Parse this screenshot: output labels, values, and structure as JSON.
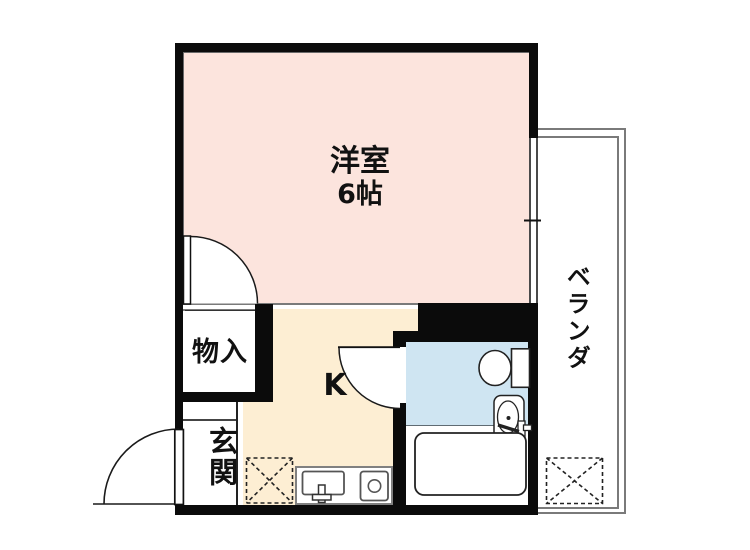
{
  "title": "1K apartment floor plan",
  "rooms": {
    "western": {
      "label": "洋室",
      "size": "6帖"
    },
    "kitchen": {
      "label": "K"
    },
    "storage": {
      "label": "物入"
    },
    "entrance": {
      "label": "玄関"
    },
    "veranda": {
      "label": "ベランダ"
    }
  },
  "fixtures": [
    "toilet",
    "washbasin",
    "bathtub",
    "kitchen-sink",
    "stove",
    "refrigerator-space",
    "washing-machine-space",
    "window",
    "hinged-doors"
  ],
  "colors": {
    "western_room_floor": "#fce4dd",
    "kitchen_floor": "#fdeed3",
    "bathroom_floor": "#cfe5f2",
    "wall": "#0b0b0b",
    "thin_line": "#7a7a7a",
    "background": "#ffffff"
  }
}
